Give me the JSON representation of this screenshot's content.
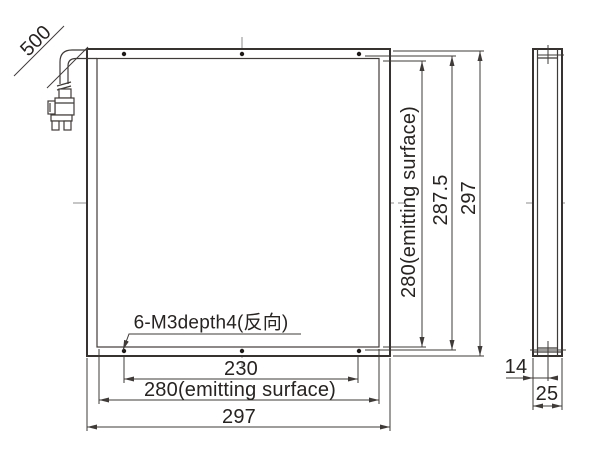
{
  "drawing": {
    "title": "panel-dimension-drawing",
    "labels": {
      "cable_length": "500",
      "thread_note": "6-M3depth4(反向)",
      "width_holes": "230",
      "width_emitting": "280(emitting surface)",
      "width_total": "297",
      "height_emitting": "280(emitting surface)",
      "height_holes": "287.5",
      "height_total": "297",
      "side_hole_offset": "14",
      "side_depth_total": "25"
    },
    "colors": {
      "background": "#ffffff",
      "line": "#36322f",
      "dimension_line": "#3f3b38",
      "centerline": "#8c8c8c",
      "text": "#262321"
    }
  }
}
